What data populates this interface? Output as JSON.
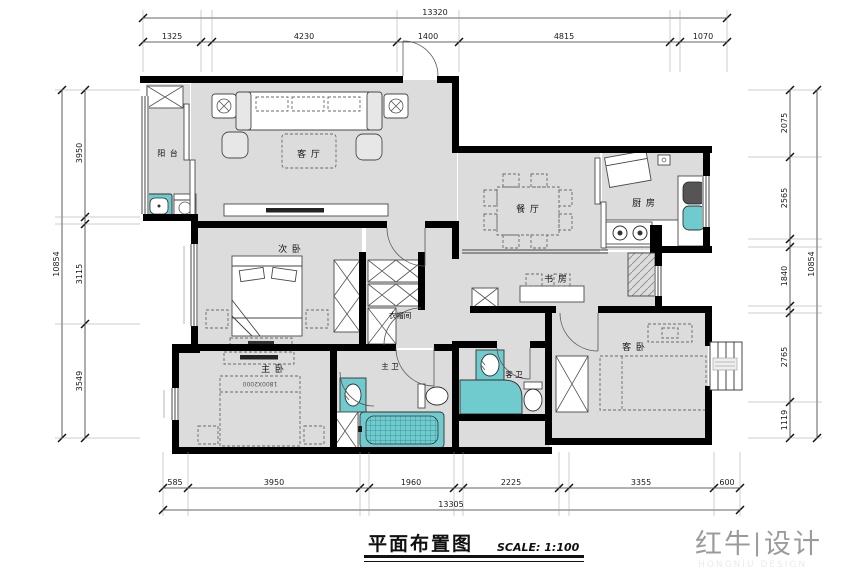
{
  "drawing": {
    "title": "平面布置图",
    "scale_label": "SCALE: 1:100"
  },
  "logo": {
    "brand_left": "红牛",
    "divider": "|",
    "brand_right": "设计",
    "subtitle": "HONGNIU DESIGN"
  },
  "rooms": {
    "balcony": "阳 台",
    "living_room": "客 厅",
    "dining_room": "餐 厅",
    "kitchen": "厨 房",
    "second_bedroom": "次 卧",
    "study": "书 房",
    "closet": "衣帽间",
    "master_bedroom": "主 卧",
    "master_bath": "主 卫",
    "guest_bath": "客 卫",
    "guest_bedroom": "客 卧",
    "master_bed_size": "1800X2000"
  },
  "dimensions": {
    "top": {
      "total": "13320",
      "segments": [
        "1325",
        "4230",
        "1400",
        "4815",
        "1070"
      ]
    },
    "bottom": {
      "total": "13305",
      "segments": [
        "585",
        "3950",
        "1960",
        "2225",
        "3355",
        "600"
      ]
    },
    "left": {
      "total": "10854",
      "segments": [
        "3950",
        "3115",
        "3549"
      ]
    },
    "right": {
      "total": "10854",
      "segments": [
        "2075",
        "2565",
        "1840",
        "2765",
        "1119"
      ]
    }
  },
  "colors": {
    "floor": "#dcdcdc",
    "wall": "#000000",
    "fixture_teal": "#6FCBCE",
    "dim_line": "#555555"
  }
}
